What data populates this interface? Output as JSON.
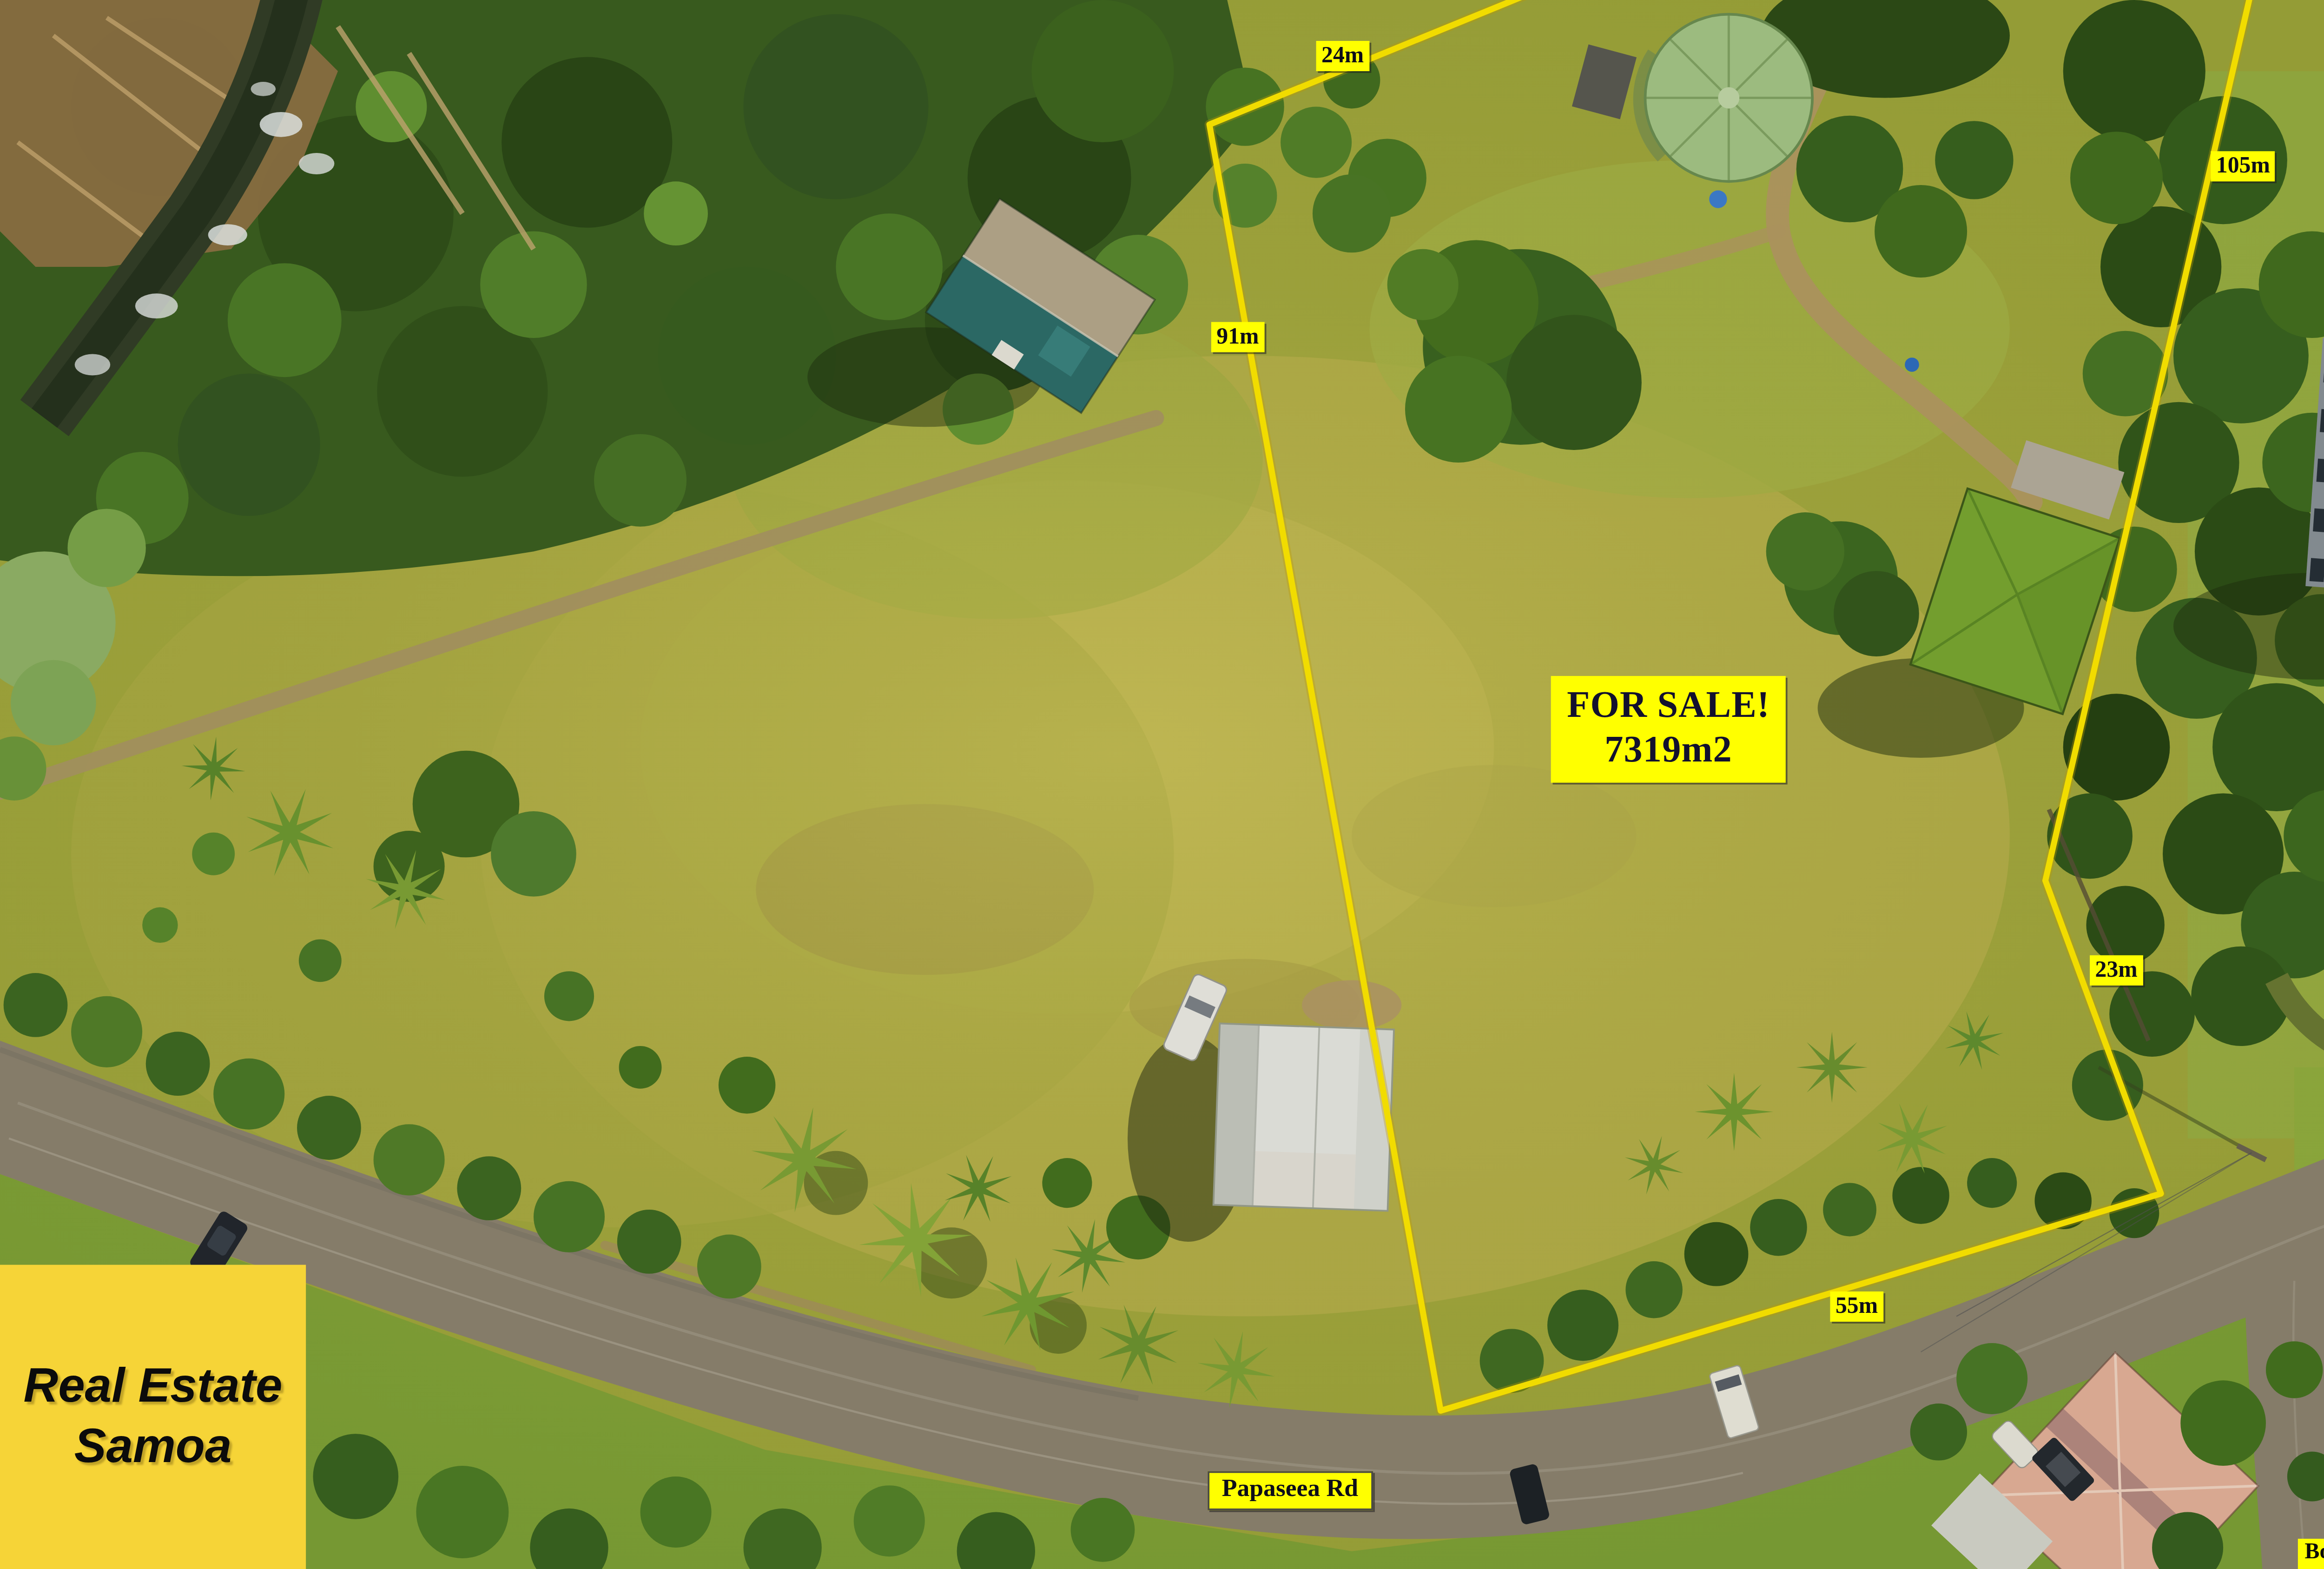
{
  "labels": {
    "for_sale": {
      "line1": "FOR SALE!",
      "line2": "7319m2"
    },
    "measurements": [
      {
        "side": "top",
        "text": "24m"
      },
      {
        "side": "left",
        "text": "91m"
      },
      {
        "side": "right-upper",
        "text": "105m"
      },
      {
        "side": "right-lower",
        "text": "23m"
      },
      {
        "side": "bottom",
        "text": "55m"
      }
    ],
    "road_name": "Papaseea Rd",
    "disclaimer": "Boundary Lines are only for illustration purposes!"
  },
  "logo": {
    "line1": "Real Estate",
    "line2": "Samoa"
  },
  "colors": {
    "boundary_line": "#FFE900",
    "label_bg": "#FFFF00",
    "label_text": "#0D0D1A",
    "logo_bg": "#F6D437",
    "logo_text": "#0B0B0B",
    "road_surface": "#8D8470",
    "field_green": "#A8A93F",
    "forest_green": "#3A5D20",
    "hut_roof_green": "#7AA831",
    "rust_roof": "#A2643F",
    "teal_roof": "#2F6F6B"
  }
}
